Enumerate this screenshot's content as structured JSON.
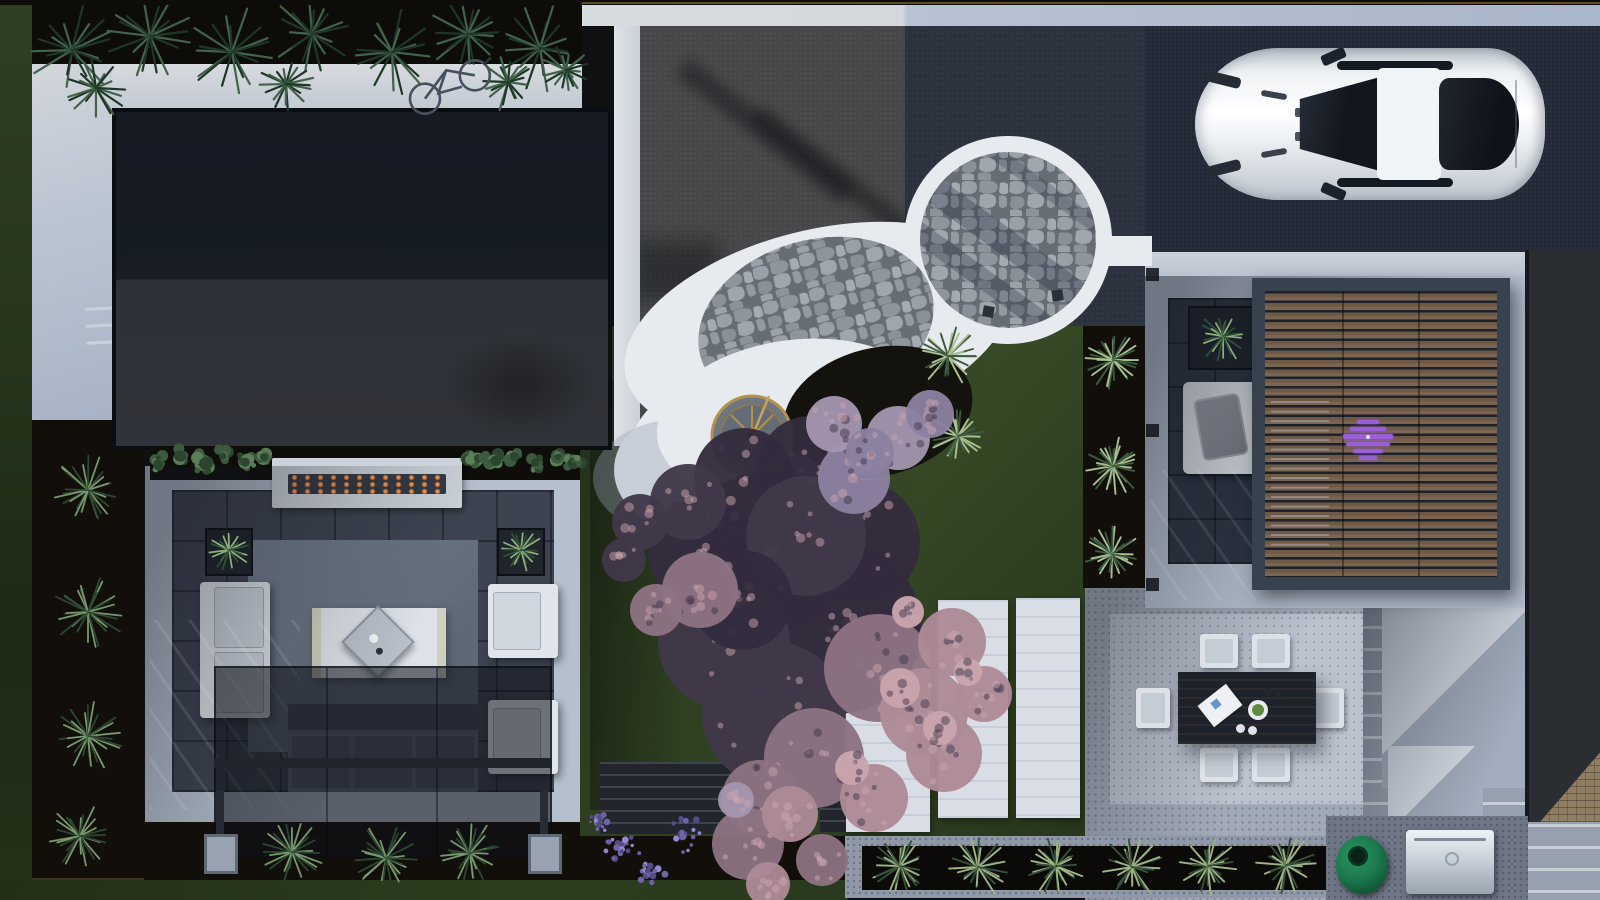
{
  "image": {
    "type": "aerial-3d-architectural-render",
    "subject": "Top-down rendering of a modern residential backyard landscape design",
    "width": 1600,
    "height": 900
  },
  "palette": {
    "base": "#101013",
    "mulch": "#120f0b",
    "pavelight": "#b5bfcd",
    "tile": "#3d4350",
    "asphaltL": "#474749",
    "asphaltR": "#2b323e",
    "driveway": "#232936",
    "white": "#e7eaee",
    "gold": "#b3924c",
    "fireOrange": "#e77f3b",
    "carWhite": "#eef1f5",
    "glass": "#161c26",
    "woodSlat": "#6e5947",
    "frameGray": "#38414e",
    "eggGreen": "#1c7a4e",
    "treePlum": "#332c3d",
    "treePink": "#c9a4ad",
    "lawnGreen": "#3a4d29"
  },
  "objects": {
    "house_roof": "flat charcoal roof of main house",
    "neighbor_roof": "dark roof of adjacent building with shingle corner",
    "driveway": "dark asphalt driveway",
    "car": "white sports car, top view",
    "bicycle": "bicycle parked on walkway",
    "stone_circle": "circular flagstone patio with white border",
    "stone_crescent": "crescent flagstone patio with white plaza",
    "fountain": "round gold-trimmed fountain sculpture",
    "blossom_tree": "large purple-pink blossom tree canopy",
    "lounge": "sunken lounge with white sofas, rug and coffee table",
    "fire_table": "linear concrete fire table with embers",
    "shade_pergola": "dark shade pergola over gray sofa",
    "wood_pergola": "wood-slat pergola with louvered roof",
    "daybed": "white daybed with gray pillow",
    "dining_set": "dark outdoor dining table with six white chairs",
    "bbq_grill": "stainless steel grill",
    "kamado_grill": "green egg kamado grill",
    "planter_box": "long concrete planter with yuccas",
    "fern_bed": "fern planting bed along top edge",
    "lavender": "lavender shrubs",
    "lawn": "clipped green lawn",
    "stepping_slabs": "white concrete stepping slabs in lawn"
  },
  "plants": {
    "top_ferns": [
      [
        72,
        50,
        46
      ],
      [
        150,
        36,
        44
      ],
      [
        232,
        52,
        46
      ],
      [
        312,
        34,
        42
      ],
      [
        392,
        52,
        44
      ],
      [
        468,
        34,
        42
      ],
      [
        540,
        48,
        44
      ],
      [
        96,
        88,
        32
      ],
      [
        286,
        84,
        28
      ],
      [
        508,
        82,
        30
      ],
      [
        566,
        70,
        26
      ]
    ],
    "hedge": [
      [
        158,
        460,
        13
      ],
      [
        180,
        456,
        11
      ],
      [
        202,
        462,
        12
      ],
      [
        224,
        456,
        12
      ],
      [
        246,
        461,
        11
      ],
      [
        264,
        457,
        10
      ],
      [
        472,
        458,
        11
      ],
      [
        492,
        462,
        12
      ],
      [
        514,
        456,
        12
      ],
      [
        536,
        461,
        12
      ],
      [
        558,
        457,
        11
      ],
      [
        574,
        462,
        10
      ]
    ],
    "side_grasses": [
      [
        88,
        490,
        36
      ],
      [
        88,
        612,
        38
      ],
      [
        88,
        736,
        36
      ],
      [
        80,
        836,
        32
      ]
    ],
    "bottom_grasses": [
      [
        292,
        852,
        32
      ],
      [
        386,
        858,
        34
      ],
      [
        470,
        853,
        32
      ]
    ],
    "lavender": [
      [
        620,
        850,
        26
      ],
      [
        684,
        834,
        24
      ],
      [
        650,
        874,
        20
      ],
      [
        600,
        820,
        16
      ]
    ],
    "yuccas_lawn": [
      [
        948,
        356,
        30
      ],
      [
        958,
        436,
        28
      ]
    ],
    "yuccas_strip": [
      [
        1113,
        360,
        30
      ],
      [
        1113,
        466,
        30
      ],
      [
        1112,
        554,
        28
      ]
    ],
    "planter_row": [
      [
        900,
        866,
        30
      ],
      [
        978,
        867,
        32
      ],
      [
        1056,
        866,
        30
      ],
      [
        1132,
        867,
        32
      ],
      [
        1208,
        866,
        30
      ],
      [
        1286,
        865,
        30
      ]
    ],
    "pot_plants": [
      [
        1223,
        336,
        26
      ],
      [
        229,
        550,
        22
      ],
      [
        521,
        550,
        22
      ]
    ]
  },
  "tree": {
    "colors": {
      "d1": "#332c3d",
      "d2": "#413849",
      "p1": "#ad8a97",
      "p2": "#8d7383",
      "p3": "#c9a4ad",
      "v1": "#8d80a0",
      "v2": "#a495b0"
    },
    "clusters": [
      [
        768,
        552,
        82,
        "d1"
      ],
      [
        836,
        628,
        86,
        "d1"
      ],
      [
        724,
        642,
        66,
        "d2"
      ],
      [
        858,
        542,
        62,
        "d1"
      ],
      [
        774,
        714,
        72,
        "d2"
      ],
      [
        704,
        552,
        56,
        "d1"
      ],
      [
        744,
        478,
        50,
        "d1"
      ],
      [
        688,
        502,
        38,
        "d2"
      ],
      [
        810,
        468,
        52,
        "d1"
      ],
      [
        640,
        522,
        28,
        "d2"
      ],
      [
        624,
        560,
        22,
        "d2"
      ],
      [
        806,
        536,
        60,
        "d2"
      ],
      [
        742,
        600,
        50,
        "d1"
      ],
      [
        878,
        668,
        54,
        "p2"
      ],
      [
        924,
        712,
        44,
        "p1"
      ],
      [
        814,
        758,
        50,
        "p2"
      ],
      [
        700,
        590,
        38,
        "p2"
      ],
      [
        952,
        642,
        34,
        "p1"
      ],
      [
        944,
        754,
        38,
        "p1"
      ],
      [
        874,
        798,
        34,
        "p1"
      ],
      [
        984,
        694,
        28,
        "p1"
      ],
      [
        760,
        798,
        38,
        "p2"
      ],
      [
        656,
        610,
        26,
        "p2"
      ],
      [
        900,
        688,
        20,
        "p3"
      ],
      [
        940,
        728,
        17,
        "p3"
      ],
      [
        852,
        768,
        17,
        "p3"
      ],
      [
        908,
        612,
        16,
        "p3"
      ],
      [
        968,
        672,
        14,
        "p3"
      ],
      [
        854,
        478,
        36,
        "v1"
      ],
      [
        898,
        438,
        32,
        "v2"
      ],
      [
        930,
        414,
        24,
        "v1"
      ],
      [
        834,
        424,
        28,
        "v2"
      ],
      [
        870,
        452,
        24,
        "v1"
      ]
    ],
    "blossom_low": [
      [
        748,
        844,
        36,
        "p2"
      ],
      [
        790,
        814,
        28,
        "p1"
      ],
      [
        822,
        860,
        26,
        "p2"
      ],
      [
        768,
        884,
        22,
        "p1"
      ],
      [
        736,
        800,
        18,
        "v2"
      ]
    ]
  }
}
